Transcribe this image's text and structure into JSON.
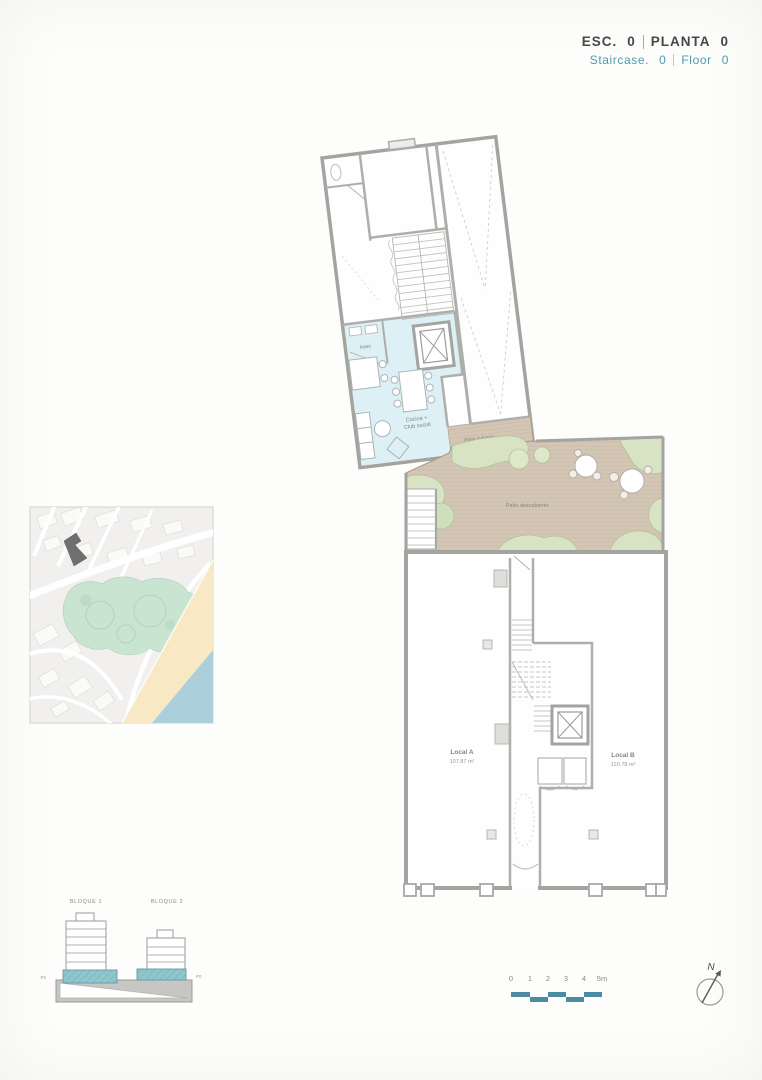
{
  "header": {
    "esc": {
      "label": "ESC.",
      "value": "0"
    },
    "planta": {
      "label": "PLANTA",
      "value": "0"
    },
    "staircase": {
      "label": "Staircase.",
      "value": "0"
    },
    "floor": {
      "label": "Floor",
      "value": "0"
    }
  },
  "floor_plan": {
    "rooms": {
      "aseo": "Aseo",
      "cocina_line1": "Cocina +",
      "cocina_line2": "Club social",
      "patio_cubierto": "Patio cubierto",
      "patio_descubierto": "Patio descubierto",
      "local_a": {
        "name": "Local A",
        "area": "107.87 m²"
      },
      "local_b": {
        "name": "Local B",
        "area": "120.78 m²"
      }
    }
  },
  "elevation": {
    "bloque_1": "BLOQUE 1",
    "bloque_2": "BLOQUE 2",
    "level_left": "P0",
    "level_right": "P0"
  },
  "scale_bar": {
    "ticks": [
      "0",
      "1",
      "2",
      "3",
      "4",
      "5m"
    ]
  },
  "compass": {
    "label": "N"
  },
  "colors": {
    "accent_teal": "#4a9cab",
    "header_dark": "#474747",
    "wall_gray": "#a8a8a5",
    "room_blue": "#dcf0f5",
    "patio_tan": "#d4c6b5",
    "planting_green": "#d8e3c4",
    "map_green": "#c9e5d2",
    "map_beach": "#f8e9c4",
    "map_water": "#abd0dc",
    "elevation_teal": "#8fc5cd",
    "scale_teal": "#4d8ba3"
  }
}
